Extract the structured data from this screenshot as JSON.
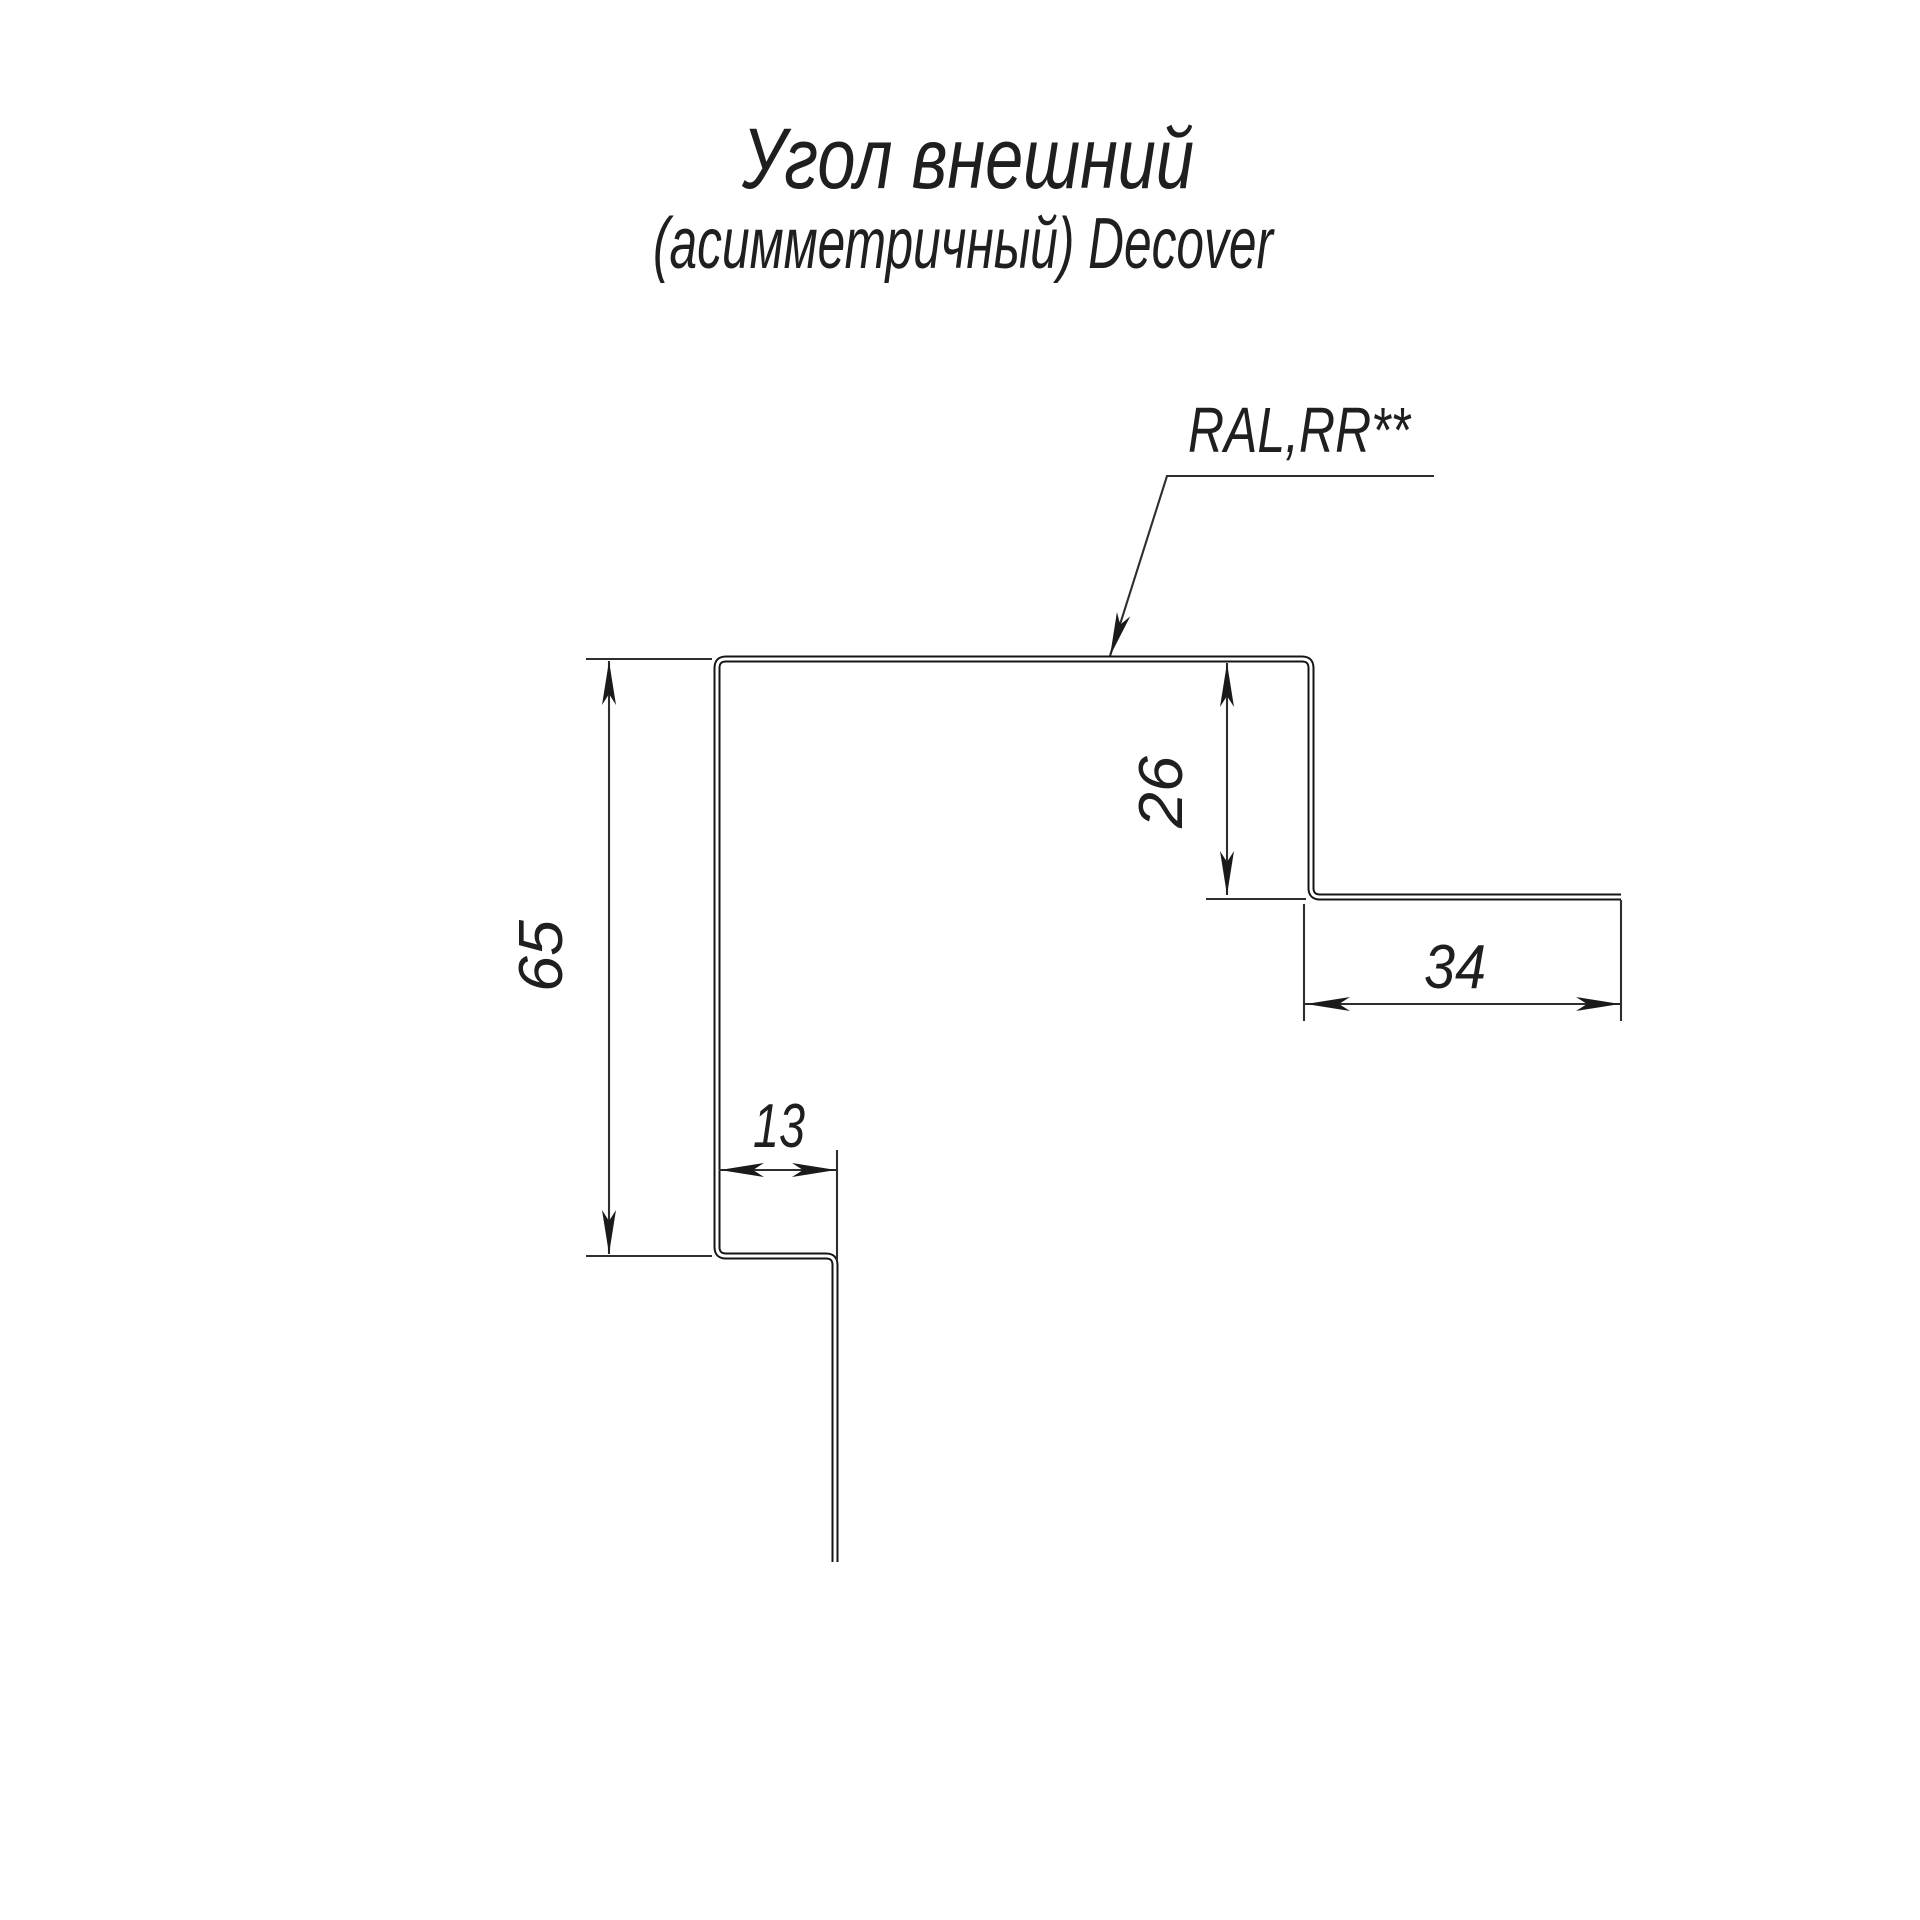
{
  "title": {
    "line1": "Угол внешний",
    "line2": "(асимметричный) Decover"
  },
  "material_label": "RAL,RR**",
  "drawing": {
    "type": "sheet-metal-profile-cross-section",
    "profile_name": "Угол внешний (асимметричный) Decover",
    "dimensions_mm": [
      {
        "id": "left-height",
        "value": "65"
      },
      {
        "id": "bottom-step",
        "value": "13"
      },
      {
        "id": "right-step",
        "value": "26"
      },
      {
        "id": "right-flange",
        "value": "34"
      }
    ],
    "colors": {
      "background": "#ffffff",
      "profile_line": "#141414",
      "dimension_line": "#2e2e2e",
      "text": "#1f1f1f"
    }
  }
}
